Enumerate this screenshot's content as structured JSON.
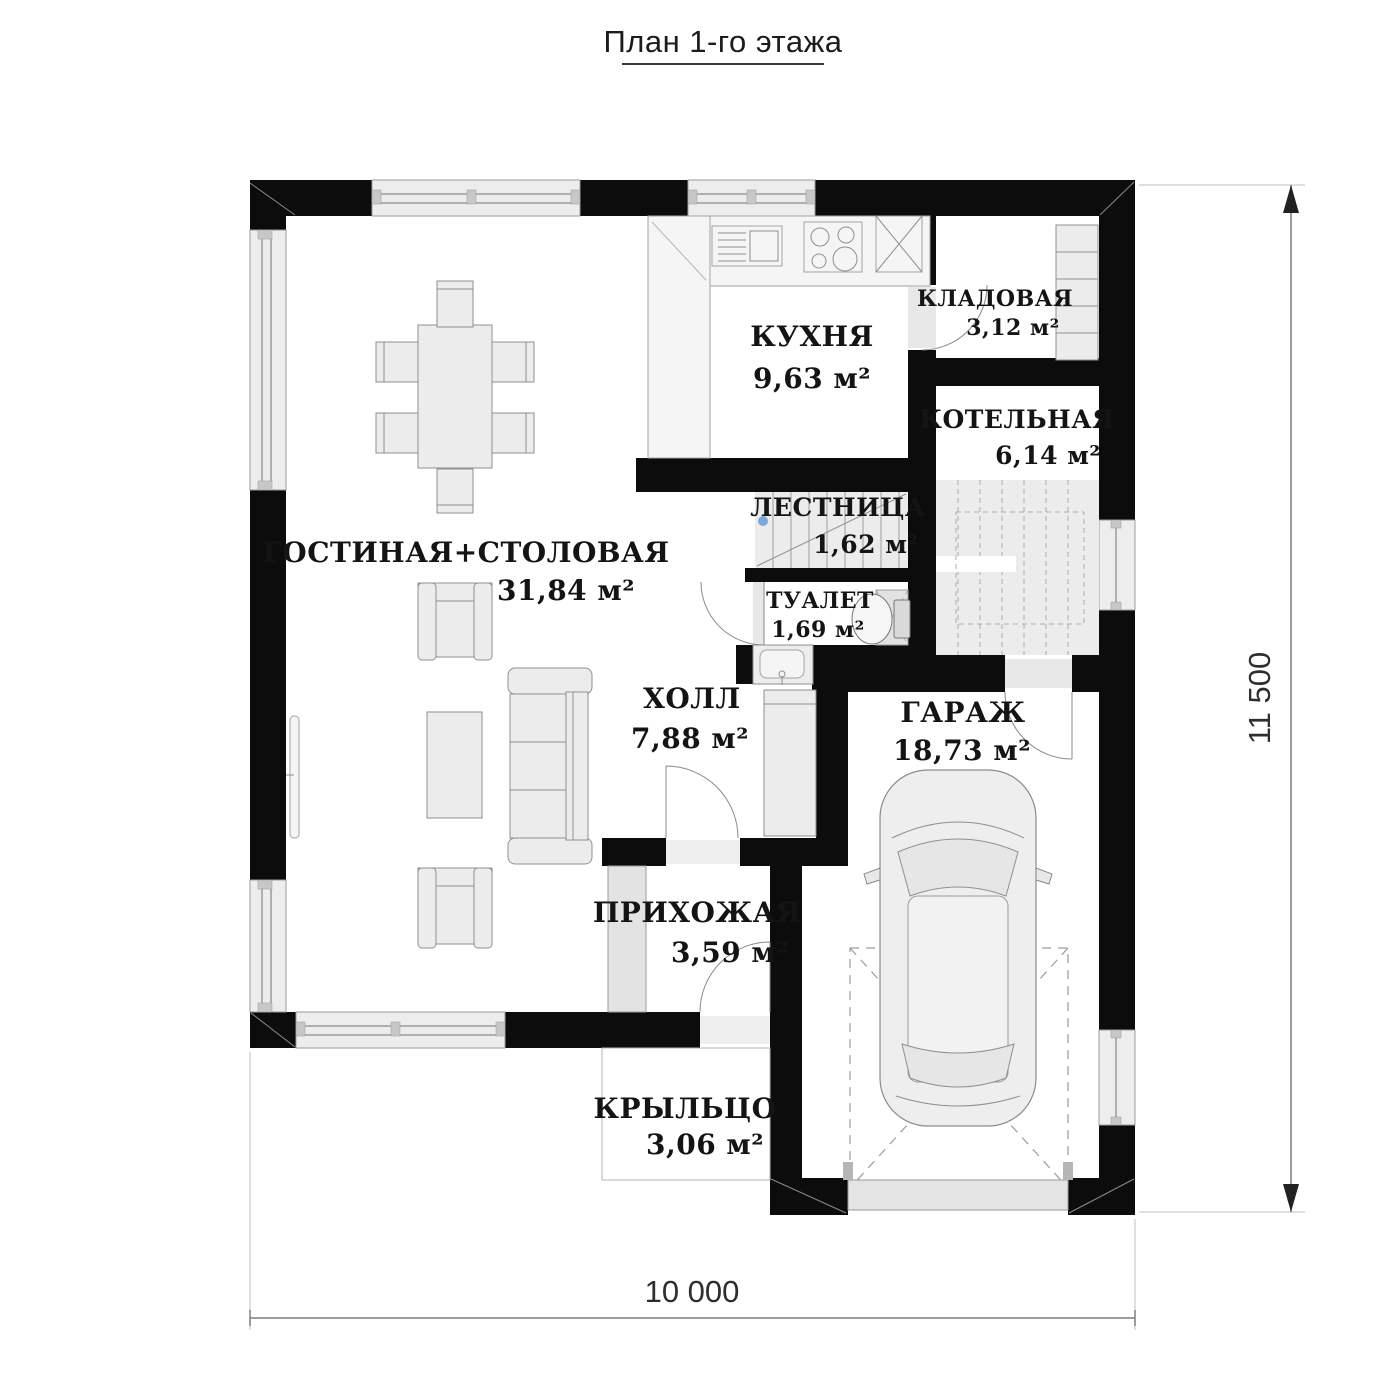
{
  "title": "План 1-го этажа",
  "plan": {
    "rooms": [
      {
        "name": "ГОСТИНАЯ+СТОЛОВАЯ",
        "area": "31,84 м²"
      },
      {
        "name": "КУХНЯ",
        "area": "9,63 м²"
      },
      {
        "name": "КЛАДОВАЯ",
        "area": "3,12 м²"
      },
      {
        "name": "КОТЕЛЬНАЯ",
        "area": "6,14 м²"
      },
      {
        "name": "ЛЕСТНИЦА",
        "area": "1,62 м²"
      },
      {
        "name": "ТУАЛЕТ",
        "area": "1,69 м²"
      },
      {
        "name": "ХОЛЛ",
        "area": "7,88 м²"
      },
      {
        "name": "ГАРАЖ",
        "area": "18,73 м²"
      },
      {
        "name": "ПРИХОЖАЯ",
        "area": "3,59 м²"
      },
      {
        "name": "КРЫЛЬЦО",
        "area": "3,06 м²"
      }
    ],
    "dimensions": {
      "width": "10 000",
      "height": "11 500"
    }
  },
  "colors": {
    "wall": "#0c0c0c",
    "window_fill": "#ededed",
    "furniture_fill": "#ececec",
    "outline": "#8f8f8f",
    "stair_start_marker": "#7da7d9",
    "dimension_text": "#2e2e2e"
  }
}
